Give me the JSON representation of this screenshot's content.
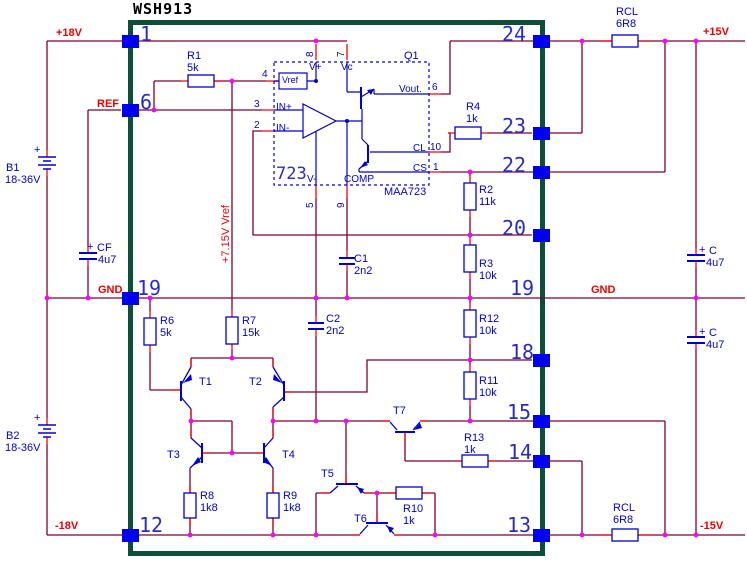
{
  "title": "WSH913",
  "rails": {
    "p18": "+18V",
    "m18": "-18V",
    "p15": "+15V",
    "m15": "-15V",
    "gnd_left": "GND",
    "gnd_right": "GND",
    "ref": "REF",
    "vref_line": "+7.15V Vref"
  },
  "pins": {
    "left": [
      "1",
      "6",
      "19",
      "12"
    ],
    "right": [
      "24",
      "23",
      "22",
      "20",
      "19",
      "18",
      "15",
      "14",
      "13"
    ]
  },
  "ic": {
    "q1": "Q1",
    "core": "723",
    "part": "MAA723",
    "vref": "Vref",
    "vplus": "V+",
    "vc": "Vc",
    "vout": "Vout.",
    "inp": "IN+",
    "inn": "IN-",
    "cl": "CL",
    "cs": "CS",
    "comp": "COMP",
    "vminus": "V-",
    "pn8": "8",
    "pn7": "7",
    "pn4": "4",
    "pn3": "3",
    "pn2": "2",
    "pn6": "6",
    "pn10": "10",
    "pn1": "1",
    "pn5": "5",
    "pn9": "9"
  },
  "components": {
    "R1": {
      "ref": "R1",
      "val": "5k"
    },
    "R2": {
      "ref": "R2",
      "val": "11k"
    },
    "R3": {
      "ref": "R3",
      "val": "10k"
    },
    "R4": {
      "ref": "R4",
      "val": "1k"
    },
    "R6": {
      "ref": "R6",
      "val": "5k"
    },
    "R7": {
      "ref": "R7",
      "val": "15k"
    },
    "R8": {
      "ref": "R8",
      "val": "1k8"
    },
    "R9": {
      "ref": "R9",
      "val": "1k8"
    },
    "R10": {
      "ref": "R10",
      "val": "1k"
    },
    "R11": {
      "ref": "R11",
      "val": "10k"
    },
    "R12": {
      "ref": "R12",
      "val": "10k"
    },
    "R13": {
      "ref": "R13",
      "val": "1k"
    },
    "C1": {
      "ref": "C1",
      "val": "2n2"
    },
    "C2": {
      "ref": "C2",
      "val": "2n2"
    },
    "CF": {
      "ref": "CF",
      "val": "4u7",
      "plus": "+"
    },
    "CU": {
      "ref": "C",
      "val": "4u7",
      "plus": "+"
    },
    "CL2": {
      "ref": "C",
      "val": "4u7",
      "plus": "+"
    },
    "RCL_T": {
      "ref": "RCL",
      "val": "6R8"
    },
    "RCL_B": {
      "ref": "RCL",
      "val": "6R8"
    },
    "B1": {
      "ref": "B1",
      "val": "18-36V",
      "plus": "+"
    },
    "B2": {
      "ref": "B2",
      "val": "18-36V",
      "plus": "+"
    },
    "T1": {
      "ref": "T1"
    },
    "T2": {
      "ref": "T2"
    },
    "T3": {
      "ref": "T3"
    },
    "T4": {
      "ref": "T4"
    },
    "T5": {
      "ref": "T5"
    },
    "T6": {
      "ref": "T6"
    },
    "T7": {
      "ref": "T7"
    }
  },
  "colors": {
    "wire": "#800030",
    "stub": "#ff0000",
    "symbol": "#0000d0",
    "pad": "#0000f0",
    "junction": "#ff00ff",
    "border": "#0b4f3a",
    "label_red": "#ee0000"
  }
}
